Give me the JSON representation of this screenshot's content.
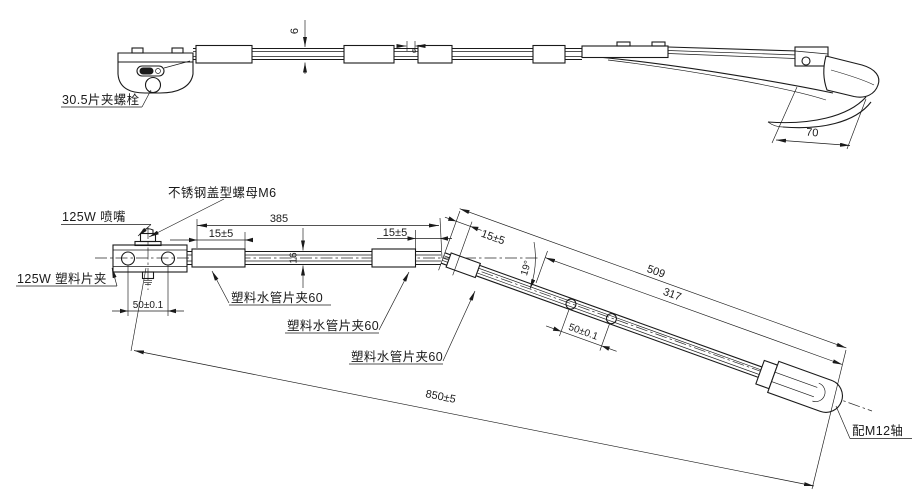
{
  "top_view": {
    "clamp_bolt_label": "30.5片夹螺栓",
    "arm_thickness_dim": "6",
    "clip_gap_dim": "6",
    "hook_width_dim": "70"
  },
  "side_view": {
    "cap_nut_label": "不锈钢盖型螺母M6",
    "nozzle_label": "125W 喷嘴",
    "plastic_clip_label": "125W 塑料片夹",
    "span_385": "385",
    "offset_15_first": "15±5",
    "offset_15_second": "15±5",
    "offset_15_third": "15±5",
    "bar_height_dim": "16",
    "bend_angle_dim": "19°",
    "span_509": "509",
    "span_317": "317",
    "hole_pitch_head": "50±0.1",
    "hole_pitch_arm": "50±0.1",
    "hose_clip_label_1": "塑料水管片夹60",
    "hose_clip_label_2": "塑料水管片夹60",
    "hose_clip_label_3": "塑料水管片夹60",
    "overall_span": "850±5",
    "shaft_label": "配M12轴"
  },
  "colors": {
    "line": "#1a1a1a",
    "background": "#ffffff"
  }
}
